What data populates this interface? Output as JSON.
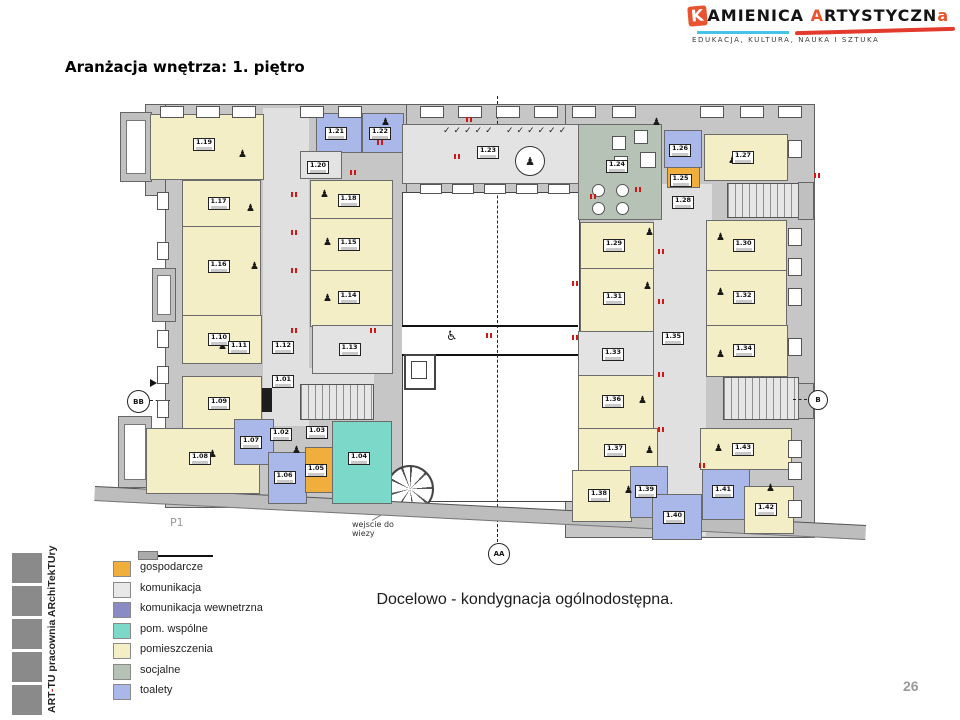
{
  "slide": {
    "title": "Aranżacja wnętrza: 1. piętro",
    "caption": "Docelowo - kondygnacja ogólnodostępna.",
    "page_number": "26",
    "sidebar_prefix": "ART",
    "sidebar_dash": "-",
    "sidebar_suffix": "TU pracownia ARchiTekTUry"
  },
  "logo": {
    "word1_initial": "K",
    "word1_rest": "AMIENICA",
    "word2_initial": "A",
    "word2_mid": "RTYSTYCZN",
    "word2_end": "a",
    "tagline": "EDUKACJA, KULTURA, NAUKA I SZTUKA",
    "accent_orange": "#e8542f",
    "accent_cyan": "#47c3e6",
    "accent_red": "#e23a2c"
  },
  "legend": {
    "items": [
      {
        "label": "gospodarcze",
        "color": "#f0ae3c"
      },
      {
        "label": "komunikacja",
        "color": "#e8e8e8"
      },
      {
        "label": "komunikacja wewnetrzna",
        "color": "#8a8ac5"
      },
      {
        "label": "pom. wspólne",
        "color": "#7cd9c9"
      },
      {
        "label": "pomieszczenia",
        "color": "#f4eec6"
      },
      {
        "label": "socjalne",
        "color": "#b7c2b7"
      },
      {
        "label": "toalety",
        "color": "#a9b8e9"
      }
    ]
  },
  "plan": {
    "floor_label": "P1",
    "tower_note": "wejscie do wiezy",
    "markers": {
      "aa": "AA",
      "bb": "BB",
      "b": "B"
    },
    "icons": {
      "person": "♟",
      "wheelchair": "♿",
      "chair": "✓"
    },
    "rooms": [
      {
        "n": "1.19",
        "t": "room",
        "x": 150,
        "y": 114,
        "w": 112,
        "h": 64
      },
      {
        "n": "1.21",
        "t": "toilet",
        "x": 316,
        "y": 113,
        "w": 44,
        "h": 38
      },
      {
        "n": "1.22",
        "t": "toilet",
        "x": 362,
        "y": 113,
        "w": 40,
        "h": 38
      },
      {
        "n": "1.20",
        "t": "gray",
        "x": 300,
        "y": 151,
        "w": 40,
        "h": 26
      },
      {
        "n": "1.23",
        "t": "gray",
        "x": 402,
        "y": 124,
        "w": 176,
        "h": 58
      },
      {
        "n": "1.24",
        "t": "social",
        "x": 578,
        "y": 124,
        "w": 82,
        "h": 94
      },
      {
        "n": "1.26",
        "t": "toilet",
        "x": 664,
        "y": 130,
        "w": 36,
        "h": 36
      },
      {
        "n": "1.25",
        "t": "utility",
        "x": 667,
        "y": 167,
        "w": 31,
        "h": 19
      },
      {
        "n": "1.27",
        "t": "room",
        "x": 704,
        "y": 134,
        "w": 82,
        "h": 45
      },
      {
        "n": "1.28",
        "t": "label",
        "x": 672,
        "y": 196,
        "w": 36,
        "h": 14
      },
      {
        "n": "1.17",
        "t": "room",
        "x": 182,
        "y": 180,
        "w": 77,
        "h": 46
      },
      {
        "n": "1.16",
        "t": "room",
        "x": 182,
        "y": 226,
        "w": 77,
        "h": 89
      },
      {
        "n": "1.18",
        "t": "room",
        "x": 310,
        "y": 180,
        "w": 81,
        "h": 38
      },
      {
        "n": "1.15",
        "t": "room",
        "x": 310,
        "y": 218,
        "w": 81,
        "h": 52
      },
      {
        "n": "1.14",
        "t": "room",
        "x": 310,
        "y": 270,
        "w": 81,
        "h": 55
      },
      {
        "n": "1.10",
        "t": "room",
        "x": 182,
        "y": 315,
        "w": 78,
        "h": 47
      },
      {
        "n": "1.13",
        "t": "gray",
        "x": 312,
        "y": 325,
        "w": 79,
        "h": 47
      },
      {
        "n": "1.11",
        "t": "label",
        "x": 228,
        "y": 341,
        "w": 32,
        "h": 14
      },
      {
        "n": "1.12",
        "t": "label",
        "x": 272,
        "y": 341,
        "w": 32,
        "h": 14
      },
      {
        "n": "1.01",
        "t": "label",
        "x": 272,
        "y": 375,
        "w": 32,
        "h": 14
      },
      {
        "n": "1.09",
        "t": "room",
        "x": 182,
        "y": 376,
        "w": 78,
        "h": 56
      },
      {
        "n": "1.08",
        "t": "room",
        "x": 146,
        "y": 428,
        "w": 112,
        "h": 64
      },
      {
        "n": "1.07",
        "t": "toilet",
        "x": 234,
        "y": 419,
        "w": 38,
        "h": 44
      },
      {
        "n": "1.02",
        "t": "label",
        "x": 270,
        "y": 428,
        "w": 28,
        "h": 13
      },
      {
        "n": "1.06",
        "t": "toilet",
        "x": 268,
        "y": 452,
        "w": 37,
        "h": 50
      },
      {
        "n": "1.05",
        "t": "utility",
        "x": 305,
        "y": 447,
        "w": 26,
        "h": 44
      },
      {
        "n": "1.03",
        "t": "label",
        "x": 306,
        "y": 426,
        "w": 28,
        "h": 13
      },
      {
        "n": "1.04",
        "t": "common",
        "x": 332,
        "y": 421,
        "w": 58,
        "h": 81
      },
      {
        "n": "1.29",
        "t": "room",
        "x": 580,
        "y": 222,
        "w": 72,
        "h": 46
      },
      {
        "n": "1.31",
        "t": "room",
        "x": 580,
        "y": 268,
        "w": 72,
        "h": 62
      },
      {
        "n": "1.33",
        "t": "gray",
        "x": 578,
        "y": 331,
        "w": 74,
        "h": 44
      },
      {
        "n": "1.36",
        "t": "room",
        "x": 578,
        "y": 375,
        "w": 74,
        "h": 53
      },
      {
        "n": "1.37",
        "t": "room",
        "x": 578,
        "y": 428,
        "w": 78,
        "h": 42
      },
      {
        "n": "1.38",
        "t": "room",
        "x": 572,
        "y": 470,
        "w": 58,
        "h": 50
      },
      {
        "n": "1.39",
        "t": "toilet",
        "x": 630,
        "y": 466,
        "w": 36,
        "h": 50
      },
      {
        "n": "1.40",
        "t": "toilet",
        "x": 652,
        "y": 494,
        "w": 48,
        "h": 44
      },
      {
        "n": "1.41",
        "t": "toilet",
        "x": 702,
        "y": 464,
        "w": 46,
        "h": 54
      },
      {
        "n": "1.42",
        "t": "room",
        "x": 744,
        "y": 486,
        "w": 48,
        "h": 46
      },
      {
        "n": "1.43",
        "t": "room",
        "x": 700,
        "y": 428,
        "w": 90,
        "h": 40
      },
      {
        "n": "1.30",
        "t": "room",
        "x": 706,
        "y": 220,
        "w": 79,
        "h": 50
      },
      {
        "n": "1.32",
        "t": "room",
        "x": 706,
        "y": 270,
        "w": 79,
        "h": 55
      },
      {
        "n": "1.34",
        "t": "room",
        "x": 706,
        "y": 325,
        "w": 80,
        "h": 50
      },
      {
        "n": "1.35",
        "t": "label",
        "x": 662,
        "y": 332,
        "w": 36,
        "h": 14
      }
    ]
  }
}
